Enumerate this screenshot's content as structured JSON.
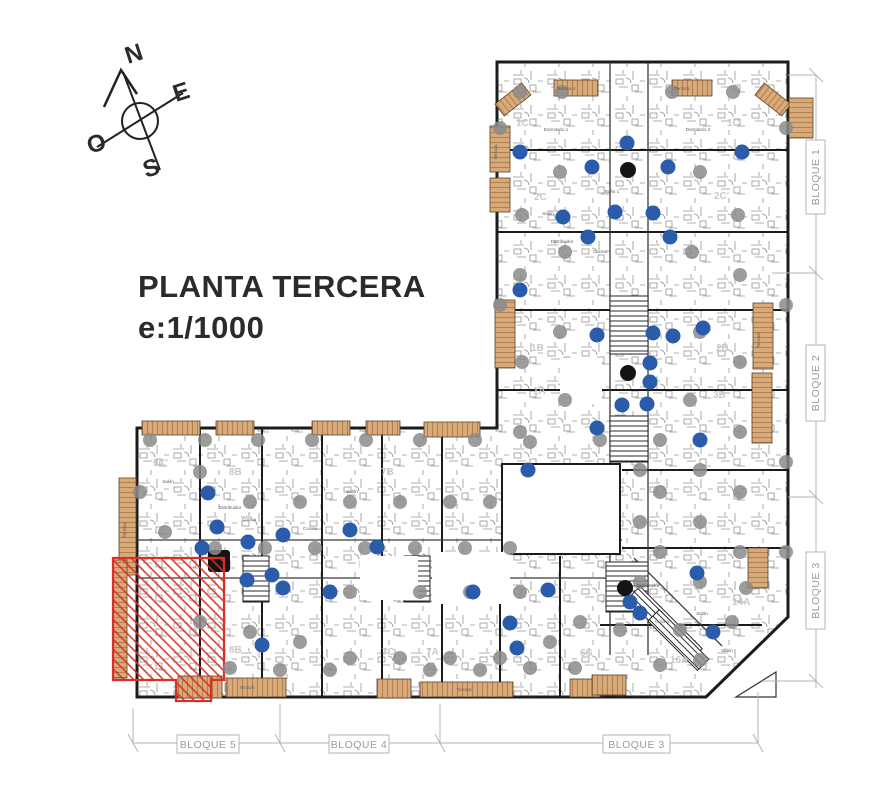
{
  "title": {
    "line1": "PLANTA TERCERA",
    "line2": "e:1/1000"
  },
  "compass": {
    "north": "N",
    "east": "E",
    "south": "S",
    "west": "O"
  },
  "dimension_labels": {
    "right": [
      "BLOQUE 1",
      "BLOQUE 2",
      "BLOQUE 3"
    ],
    "bottom": [
      "BLOQUE 5",
      "BLOQUE 4",
      "BLOQUE 3"
    ]
  },
  "colors": {
    "wall": "#1b1b1b",
    "detail": "#3c3c3c",
    "terrace_fill": "#d9ab7a",
    "terrace_stripe": "#b0804e",
    "highlight_red": "#d93025",
    "dot_blue": "#2a5cab",
    "dot_gray": "#8b8b8b",
    "dot_black": "#141414",
    "dim_gray": "#b4b4b4",
    "dim_text": "#9a9a9a",
    "unit_label": "#c9c9c9",
    "room_label": "#5a5a5a"
  },
  "plan": {
    "unit_labels": [
      {
        "t": "1C'",
        "x": 516,
        "y": 126
      },
      {
        "t": "1C",
        "x": 727,
        "y": 126
      },
      {
        "t": "2C",
        "x": 534,
        "y": 200
      },
      {
        "t": "2C'",
        "x": 714,
        "y": 199
      },
      {
        "t": "1B",
        "x": 531,
        "y": 351
      },
      {
        "t": "2B",
        "x": 716,
        "y": 351
      },
      {
        "t": "1A",
        "x": 533,
        "y": 394
      },
      {
        "t": "3B",
        "x": 713,
        "y": 398
      },
      {
        "t": "9C'",
        "x": 153,
        "y": 466
      },
      {
        "t": "8B",
        "x": 229,
        "y": 475
      },
      {
        "t": "7B",
        "x": 381,
        "y": 475
      },
      {
        "t": "8B",
        "x": 229,
        "y": 653
      },
      {
        "t": "7C",
        "x": 382,
        "y": 655
      },
      {
        "t": "7A",
        "x": 426,
        "y": 655
      },
      {
        "t": "6C",
        "x": 580,
        "y": 656
      },
      {
        "t": "14A",
        "x": 732,
        "y": 605
      },
      {
        "t": "16A",
        "x": 670,
        "y": 663
      }
    ],
    "room_labels": [
      [
        "Terraza 2",
        566,
        90,
        0
      ],
      [
        "Terraza",
        682,
        90,
        0
      ],
      [
        "Terraza",
        497,
        152,
        -90
      ],
      [
        "Terraza",
        760,
        340,
        -90
      ],
      [
        "Salón",
        548,
        215,
        0
      ],
      [
        "Cocina",
        600,
        253,
        0
      ],
      [
        "Distribuidor",
        562,
        243,
        0
      ],
      [
        "Dormitorio 1",
        556,
        131,
        0
      ],
      [
        "Dormitorio 2",
        698,
        131,
        0
      ],
      [
        "Baño 1",
        612,
        193,
        0
      ],
      [
        "Salón",
        168,
        483,
        0
      ],
      [
        "Cocina",
        249,
        521,
        0
      ],
      [
        "Distribuidor",
        230,
        509,
        0
      ],
      [
        "Terraza",
        126,
        530,
        -90
      ],
      [
        "Salón",
        352,
        493,
        0
      ],
      [
        "Cocina",
        310,
        530,
        0
      ],
      [
        "Terraza",
        247,
        689,
        0
      ],
      [
        "Terraza",
        464,
        691,
        0
      ],
      [
        "Distribuidor",
        648,
        587,
        0
      ],
      [
        "Cocina",
        662,
        623,
        0
      ],
      [
        "Salón",
        702,
        615,
        0
      ],
      [
        "Salón",
        727,
        652,
        0
      ]
    ],
    "terraces": [
      {
        "x": 554,
        "y": 80,
        "w": 44,
        "h": 16,
        "o": "v"
      },
      {
        "x": 672,
        "y": 80,
        "w": 40,
        "h": 16,
        "o": "v"
      },
      {
        "x": 496,
        "y": 92,
        "w": 34,
        "h": 15,
        "o": "v",
        "r": -38
      },
      {
        "x": 756,
        "y": 92,
        "w": 34,
        "h": 15,
        "o": "v",
        "r": 38
      },
      {
        "x": 490,
        "y": 126,
        "w": 20,
        "h": 46,
        "o": "h"
      },
      {
        "x": 490,
        "y": 178,
        "w": 20,
        "h": 34,
        "o": "h"
      },
      {
        "x": 495,
        "y": 300,
        "w": 20,
        "h": 68,
        "o": "h"
      },
      {
        "x": 753,
        "y": 303,
        "w": 20,
        "h": 66,
        "o": "h"
      },
      {
        "x": 752,
        "y": 373,
        "w": 20,
        "h": 70,
        "o": "h"
      },
      {
        "x": 789,
        "y": 98,
        "w": 24,
        "h": 40,
        "o": "h"
      },
      {
        "x": 748,
        "y": 548,
        "w": 20,
        "h": 40,
        "o": "h"
      },
      {
        "x": 142,
        "y": 421,
        "w": 58,
        "h": 14,
        "o": "v"
      },
      {
        "x": 216,
        "y": 421,
        "w": 38,
        "h": 14,
        "o": "v"
      },
      {
        "x": 312,
        "y": 421,
        "w": 38,
        "h": 14,
        "o": "v"
      },
      {
        "x": 366,
        "y": 421,
        "w": 34,
        "h": 14,
        "o": "v"
      },
      {
        "x": 424,
        "y": 422,
        "w": 56,
        "h": 15,
        "o": "v"
      },
      {
        "x": 119,
        "y": 478,
        "w": 17,
        "h": 97,
        "o": "h"
      },
      {
        "x": 113,
        "y": 560,
        "w": 14,
        "h": 118,
        "o": "h"
      },
      {
        "x": 178,
        "y": 676,
        "w": 44,
        "h": 22,
        "o": "v"
      },
      {
        "x": 226,
        "y": 678,
        "w": 60,
        "h": 19,
        "o": "v"
      },
      {
        "x": 377,
        "y": 679,
        "w": 34,
        "h": 19,
        "o": "v"
      },
      {
        "x": 420,
        "y": 682,
        "w": 93,
        "h": 15,
        "o": "v"
      },
      {
        "x": 570,
        "y": 679,
        "w": 30,
        "h": 18,
        "o": "v"
      },
      {
        "x": 592,
        "y": 675,
        "w": 34,
        "h": 20,
        "o": "v"
      }
    ],
    "dots": {
      "blue": [
        [
          520,
          152
        ],
        [
          742,
          152
        ],
        [
          627,
          143
        ],
        [
          592,
          167
        ],
        [
          668,
          167
        ],
        [
          563,
          217
        ],
        [
          615,
          212
        ],
        [
          653,
          213
        ],
        [
          588,
          237
        ],
        [
          670,
          237
        ],
        [
          520,
          290
        ],
        [
          597,
          335
        ],
        [
          653,
          333
        ],
        [
          673,
          336
        ],
        [
          703,
          328
        ],
        [
          650,
          363
        ],
        [
          650,
          382
        ],
        [
          622,
          405
        ],
        [
          647,
          404
        ],
        [
          597,
          428
        ],
        [
          700,
          440
        ],
        [
          528,
          470
        ],
        [
          640,
          613
        ],
        [
          697,
          573
        ],
        [
          713,
          632
        ],
        [
          630,
          602
        ],
        [
          208,
          493
        ],
        [
          217,
          527
        ],
        [
          202,
          548
        ],
        [
          248,
          542
        ],
        [
          283,
          535
        ],
        [
          272,
          575
        ],
        [
          283,
          588
        ],
        [
          247,
          580
        ],
        [
          377,
          547
        ],
        [
          350,
          530
        ],
        [
          473,
          592
        ],
        [
          548,
          590
        ],
        [
          510,
          623
        ],
        [
          517,
          648
        ],
        [
          262,
          645
        ],
        [
          330,
          592
        ]
      ],
      "gray": [
        [
          520,
          92
        ],
        [
          562,
          92
        ],
        [
          672,
          92
        ],
        [
          733,
          92
        ],
        [
          500,
          128
        ],
        [
          786,
          128
        ],
        [
          560,
          172
        ],
        [
          700,
          172
        ],
        [
          522,
          215
        ],
        [
          738,
          215
        ],
        [
          565,
          252
        ],
        [
          692,
          252
        ],
        [
          520,
          275
        ],
        [
          740,
          275
        ],
        [
          500,
          305
        ],
        [
          786,
          305
        ],
        [
          560,
          332
        ],
        [
          700,
          332
        ],
        [
          522,
          362
        ],
        [
          740,
          362
        ],
        [
          565,
          400
        ],
        [
          690,
          400
        ],
        [
          520,
          432
        ],
        [
          740,
          432
        ],
        [
          600,
          440
        ],
        [
          660,
          440
        ],
        [
          786,
          462
        ],
        [
          700,
          470
        ],
        [
          640,
          470
        ],
        [
          740,
          492
        ],
        [
          660,
          492
        ],
        [
          700,
          522
        ],
        [
          640,
          522
        ],
        [
          740,
          552
        ],
        [
          660,
          552
        ],
        [
          786,
          552
        ],
        [
          700,
          582
        ],
        [
          746,
          588
        ],
        [
          640,
          582
        ],
        [
          620,
          630
        ],
        [
          680,
          630
        ],
        [
          700,
          660
        ],
        [
          660,
          665
        ],
        [
          732,
          622
        ],
        [
          150,
          440
        ],
        [
          205,
          440
        ],
        [
          258,
          440
        ],
        [
          312,
          440
        ],
        [
          366,
          440
        ],
        [
          420,
          440
        ],
        [
          475,
          440
        ],
        [
          530,
          442
        ],
        [
          140,
          492
        ],
        [
          200,
          472
        ],
        [
          250,
          502
        ],
        [
          300,
          502
        ],
        [
          350,
          502
        ],
        [
          400,
          502
        ],
        [
          450,
          502
        ],
        [
          490,
          502
        ],
        [
          165,
          532
        ],
        [
          215,
          548
        ],
        [
          265,
          548
        ],
        [
          315,
          548
        ],
        [
          365,
          548
        ],
        [
          415,
          548
        ],
        [
          465,
          548
        ],
        [
          510,
          548
        ],
        [
          350,
          592
        ],
        [
          420,
          592
        ],
        [
          470,
          592
        ],
        [
          520,
          592
        ],
        [
          200,
          622
        ],
        [
          250,
          632
        ],
        [
          300,
          642
        ],
        [
          350,
          658
        ],
        [
          400,
          658
        ],
        [
          450,
          658
        ],
        [
          500,
          658
        ],
        [
          550,
          642
        ],
        [
          580,
          622
        ],
        [
          230,
          668
        ],
        [
          280,
          670
        ],
        [
          330,
          670
        ],
        [
          430,
          670
        ],
        [
          480,
          670
        ],
        [
          530,
          668
        ],
        [
          575,
          668
        ]
      ],
      "black": [
        [
          628,
          170
        ],
        [
          628,
          373
        ],
        [
          625,
          588
        ]
      ]
    },
    "highlight": {
      "path": "M113,558 L224,558 L224,680 L211,680 L211,701 L176,701 L176,680 L113,680 Z"
    }
  }
}
